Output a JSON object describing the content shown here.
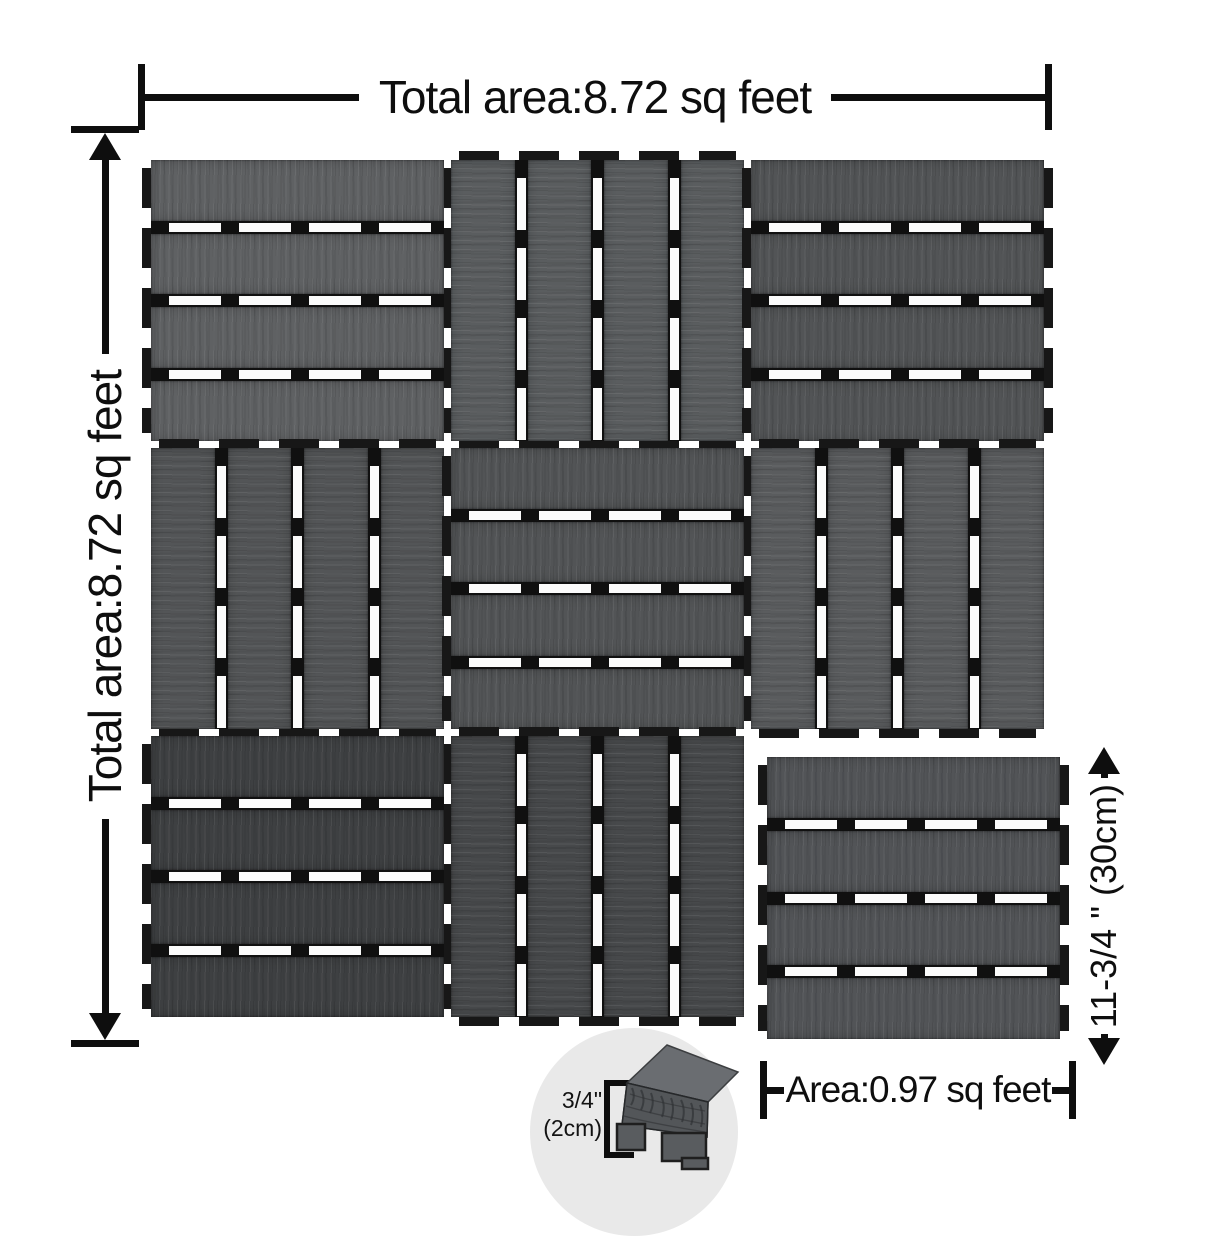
{
  "annotations": {
    "total_area_top": "Total area:8.72 sq feet",
    "total_area_left": "Total area:8.72 sq feet",
    "single_tile_height": "11-3/4 \" (30cm)",
    "single_tile_area": "Area:0.97 sq feet",
    "thickness_line1": "3/4\"",
    "thickness_line2": "(2cm)"
  },
  "tiles": {
    "slats_per_tile": 4,
    "grid": [
      [
        {
          "orientation": "h",
          "shade": "#5f6163"
        },
        {
          "orientation": "v",
          "shade": "#5a5d5f"
        },
        {
          "orientation": "h",
          "shade": "#525456"
        }
      ],
      [
        {
          "orientation": "v",
          "shade": "#535557"
        },
        {
          "orientation": "h",
          "shade": "#525456"
        },
        {
          "orientation": "v",
          "shade": "#5a5c5e"
        }
      ],
      [
        {
          "orientation": "h",
          "shade": "#3e4042"
        },
        {
          "orientation": "v",
          "shade": "#47494b"
        },
        null
      ]
    ],
    "single": {
      "orientation": "h",
      "shade": "#525457"
    }
  },
  "colors": {
    "dimension_line": "#0e0e0e",
    "gap_black": "#101010",
    "slot_white": "#fbfbfb",
    "inset_circle": "#e9e9e9",
    "background": "#ffffff"
  }
}
